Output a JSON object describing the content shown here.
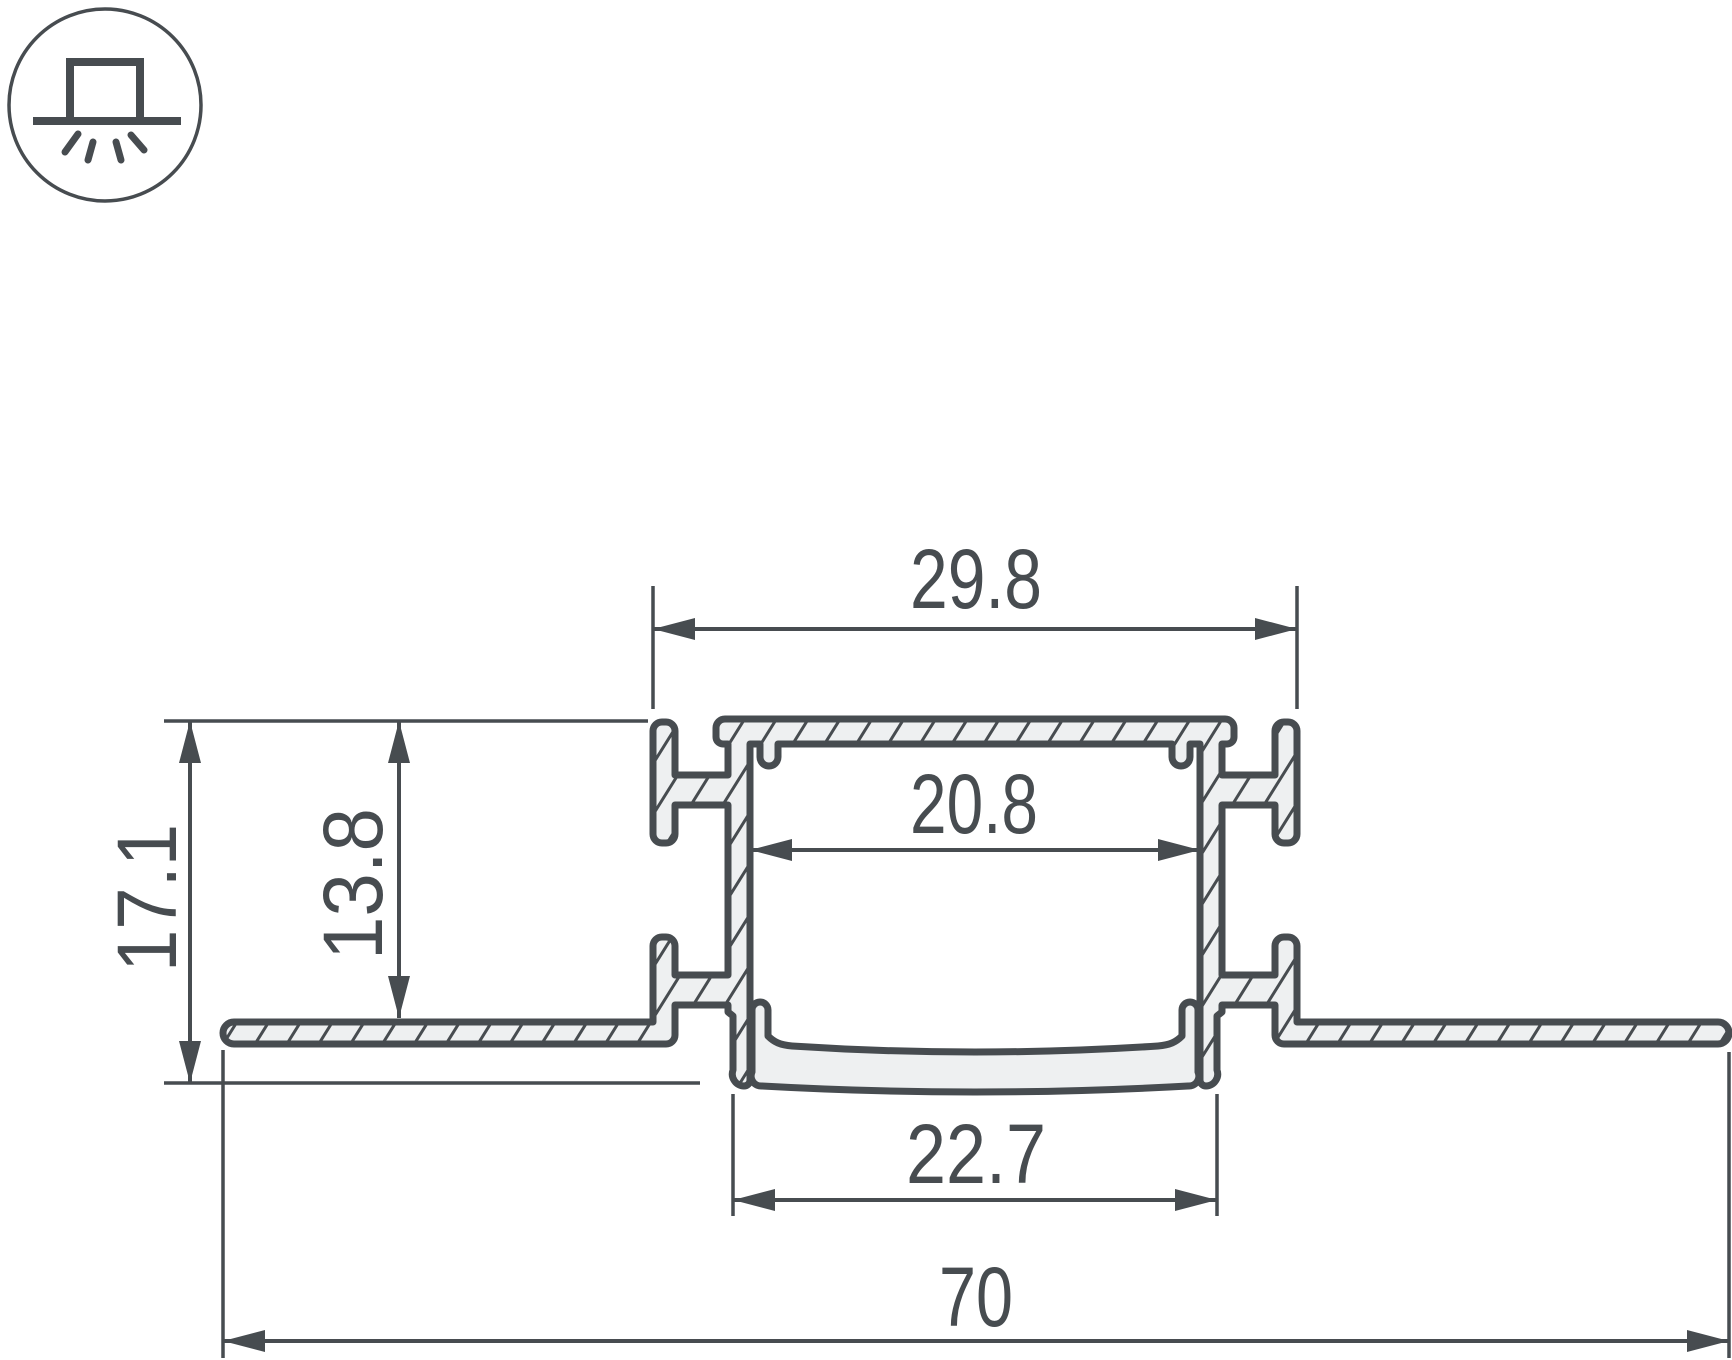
{
  "dimensions": {
    "top_width": "29.8",
    "inner_width": "20.8",
    "inner_height": "13.8",
    "overall_height": "17.1",
    "bottom_width": "22.7",
    "overall_width": "70"
  },
  "icons": [
    {
      "name": "recessed-mount-icon"
    }
  ],
  "colors": {
    "line": "#474c50",
    "profile_fill": "#eef0f1",
    "background": "#ffffff"
  }
}
